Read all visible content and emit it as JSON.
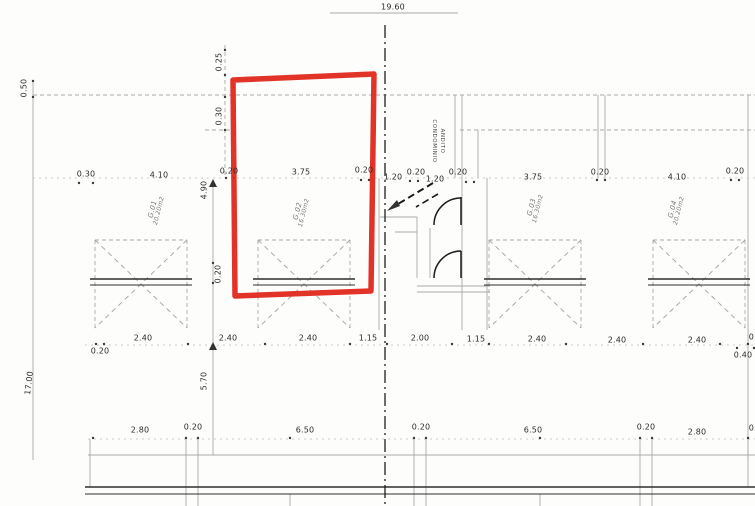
{
  "colors": {
    "marker_red": "#e0281c",
    "line_gray": "#a9a9a9",
    "ink": "#2b2b2b"
  },
  "dimensions": {
    "overall_width": "19.60",
    "row_main": [
      "0.30",
      "4.10",
      "0.20",
      "3.75",
      "0.20",
      "1.20",
      "0.20",
      "1.20",
      "0.20",
      "3.75",
      "0.20",
      "4.10",
      "0.20"
    ],
    "row_doors": [
      "0.20",
      "2.40",
      "2.40",
      "2.40",
      "1.15",
      "2.00",
      "1.15",
      "2.40",
      "2.40",
      "2.40",
      "0.20",
      "0.40"
    ],
    "row_bottom": [
      "2.80",
      "0.20",
      "6.50",
      "0.20",
      "6.50",
      "0.20",
      "2.80",
      "0.20"
    ],
    "left_column": [
      "0.50",
      "17.00"
    ],
    "inner_column": [
      "0.25",
      "0.30",
      "4.90",
      "0.20",
      "5.70"
    ]
  },
  "garages": [
    {
      "label": "G.01",
      "area": "20.20m2"
    },
    {
      "label": "G.02",
      "area": "16.30m2"
    },
    {
      "label": "G.03",
      "area": "16.30m2"
    },
    {
      "label": "G.04",
      "area": "20.20m2"
    }
  ],
  "center_label": {
    "line1": "ANDITO",
    "line2": "CONDOMINIO"
  }
}
